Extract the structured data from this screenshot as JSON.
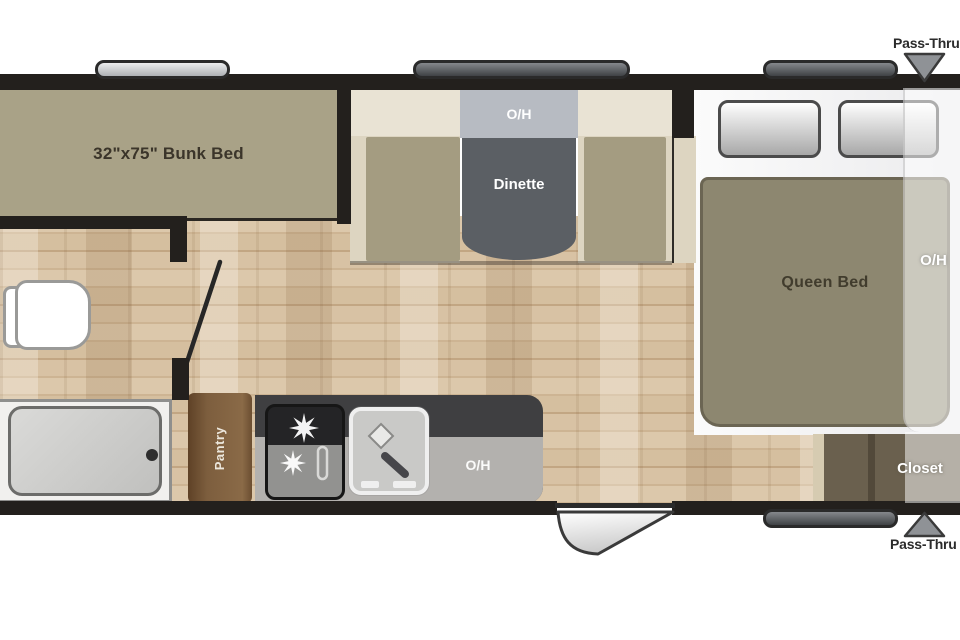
{
  "colors": {
    "wall": "#23201d",
    "wood-a": "#dcc8ab",
    "wood-b": "#cdb493",
    "bunk": "#a9a287",
    "bunk-text": "#3b352a",
    "bench-tan": "#ddd5c1",
    "bench-back": "#e9e3d4",
    "cushion": "#a49c81",
    "oh-gray": "#b7bbc2",
    "table": "#5b5f64",
    "bed": "#8d8770",
    "bed-border": "#6b6553",
    "bed-text": "#413c2d",
    "pantry": "#7a5b3c",
    "counter": "#3f3f41",
    "counter-band": "#b3b1ae",
    "cabinet": "#6a604e",
    "closet-tan": "#d6cbb1",
    "label-dark": "#2b2b2b"
  },
  "labels": {
    "bunk_bed": "32\"x75\" Bunk Bed",
    "dinette_overhead": "O/H",
    "dinette": "Dinette",
    "queen_bed": "Queen Bed",
    "bedroom_overhead": "O/H",
    "closet": "Closet",
    "kitchen_overhead": "O/H",
    "pantry": "Pantry",
    "pass_thru_top": "Pass-Thru",
    "pass_thru_bottom": "Pass-Thru"
  }
}
